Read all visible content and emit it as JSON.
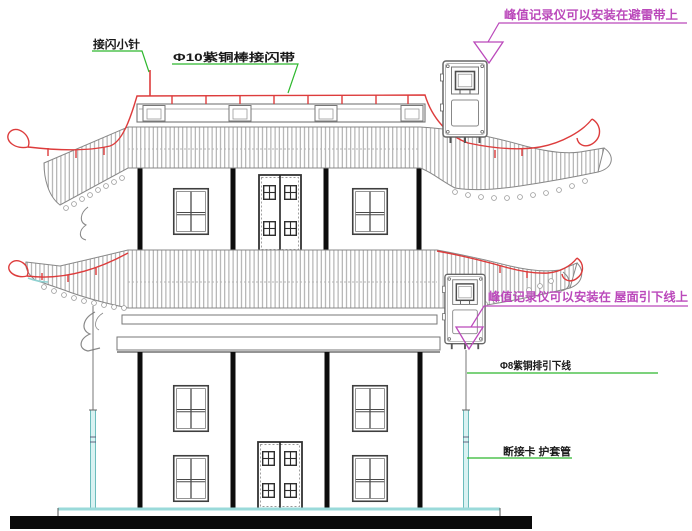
{
  "drawing": {
    "title": "pagoda-lightning-protection-elevation",
    "labels": {
      "air_terminal": "接闪小针",
      "lightning_belt": "Φ10紫铜棒接闪带",
      "recorder_on_belt": "峰值记录仪可以安装在避雷带上",
      "recorder_on_downlead": "峰值记录仪可以安装在 屋面引下线上",
      "down_conductor": "Φ8紫铜排引下线",
      "disconnect_card_sleeve": "断接卡 护套管"
    },
    "colors": {
      "belt_red": "#dd3c3c",
      "annotation_magenta": "#bb49bb",
      "leader_green": "#2eb82e",
      "sleeve_cyan": "#8fd2d2",
      "drawing_grey": "#808080",
      "base_black": "#0a0a0a"
    },
    "symbols": {
      "recorder_device": "peak-value-recorder-box",
      "callout_marker": "triangle-callout"
    }
  }
}
